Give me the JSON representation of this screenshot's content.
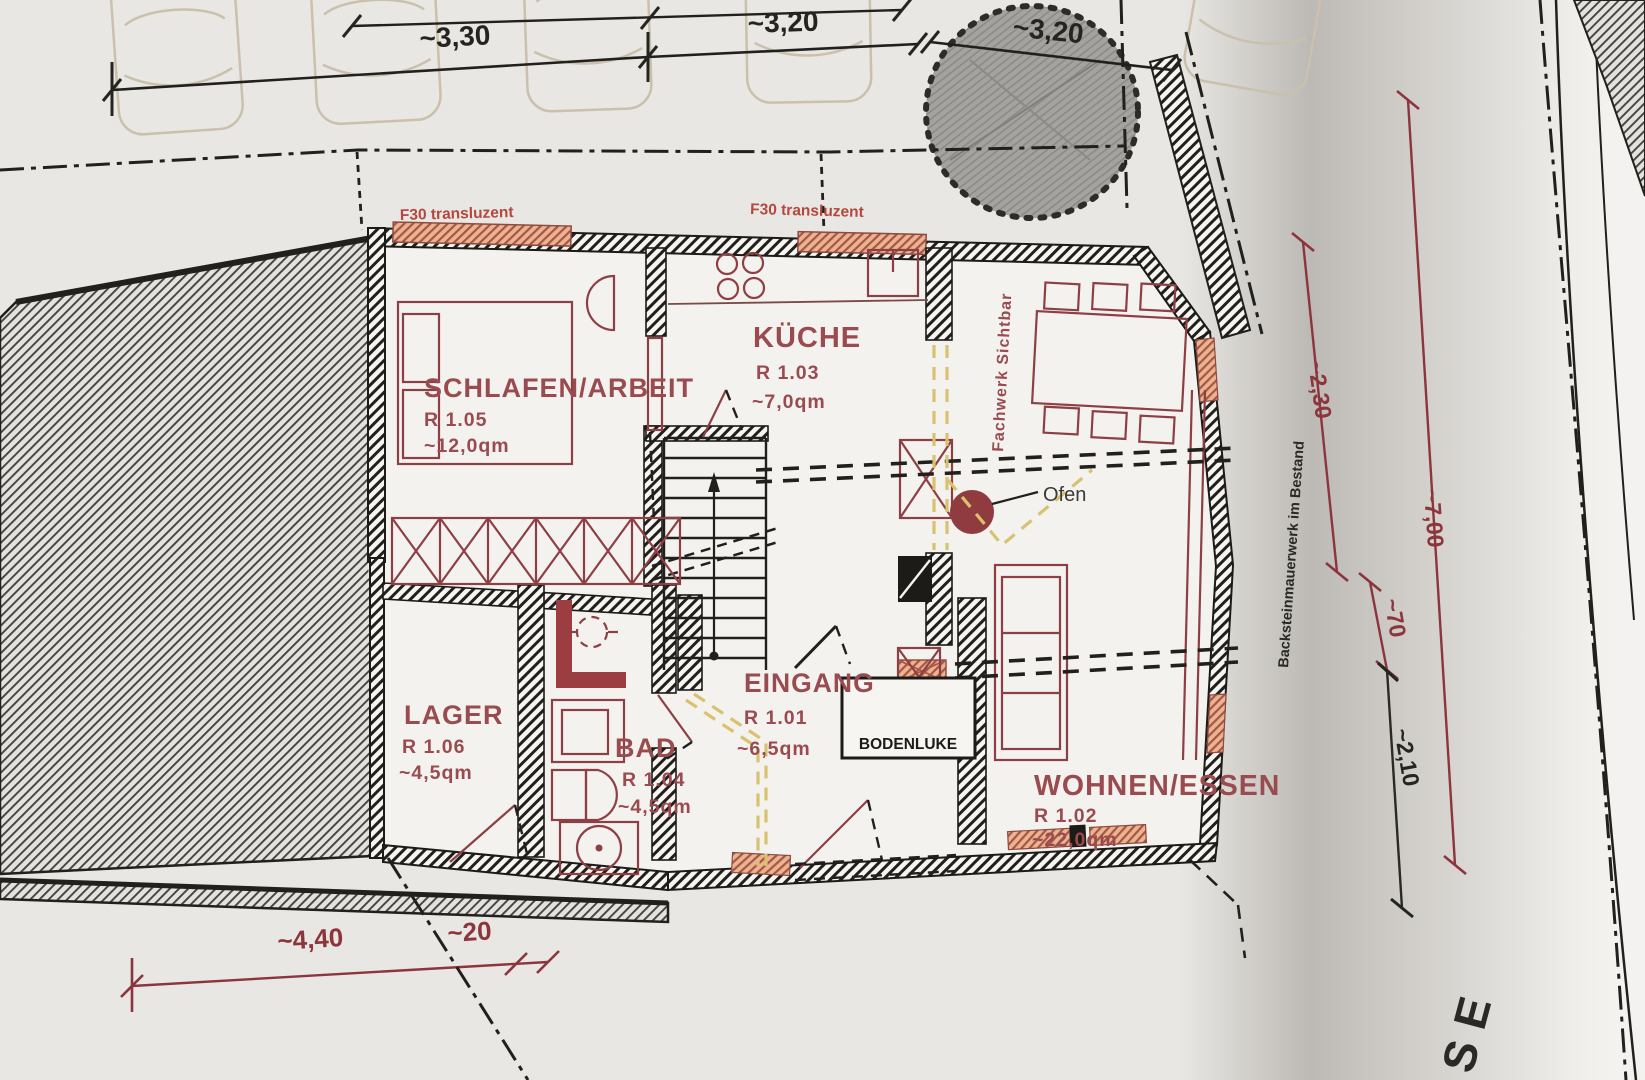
{
  "dimensions": {
    "top": [
      {
        "label": "~3,30"
      },
      {
        "label": "~3,20"
      },
      {
        "label": "~3,20"
      }
    ],
    "right": [
      {
        "label": "~2,30"
      },
      {
        "label": "~7,00"
      },
      {
        "label": "~70"
      },
      {
        "label": "~2,10"
      }
    ],
    "bottom": [
      {
        "label": "~4,40"
      },
      {
        "label": "~20"
      }
    ]
  },
  "rooms": {
    "schlafen": {
      "name": "SCHLAFEN/ARBEIT",
      "number": "R 1.05",
      "area": "~12,0qm"
    },
    "kueche": {
      "name": "KÜCHE",
      "number": "R 1.03",
      "area": "~7,0qm"
    },
    "wohnen": {
      "name": "WOHNEN/ESSEN",
      "number": "R 1.02",
      "area": "~22,0qm"
    },
    "eingang": {
      "name": "EINGANG",
      "number": "R 1.01",
      "area": "~6,5qm"
    },
    "bad": {
      "name": "BAD",
      "number": "R 1.04",
      "area": "~4,5qm"
    },
    "lager": {
      "name": "LAGER",
      "number": "R 1.06",
      "area": "~4,5qm"
    }
  },
  "annotations": {
    "f30_left": "F30 transluzent",
    "f30_right": "F30 transluzent",
    "fachwerk": "Fachwerk Sichtbar",
    "backstein": "Backsteinmauerwerk im Bestand",
    "bodenluke": "BODENLUKE",
    "ofen": "Ofen",
    "street": "SE"
  },
  "colors": {
    "wall_ink": "#24221f",
    "furniture_red": "#8e3f44",
    "label_red": "#9a4b50",
    "dim_red": "#8c353c",
    "window_orange": "#eab58e",
    "window_stripe": "#a8544a",
    "demolition_yellow": "#d9c26f",
    "tree_gray": "#a4a3a0",
    "paper": "#e9e7e3"
  }
}
